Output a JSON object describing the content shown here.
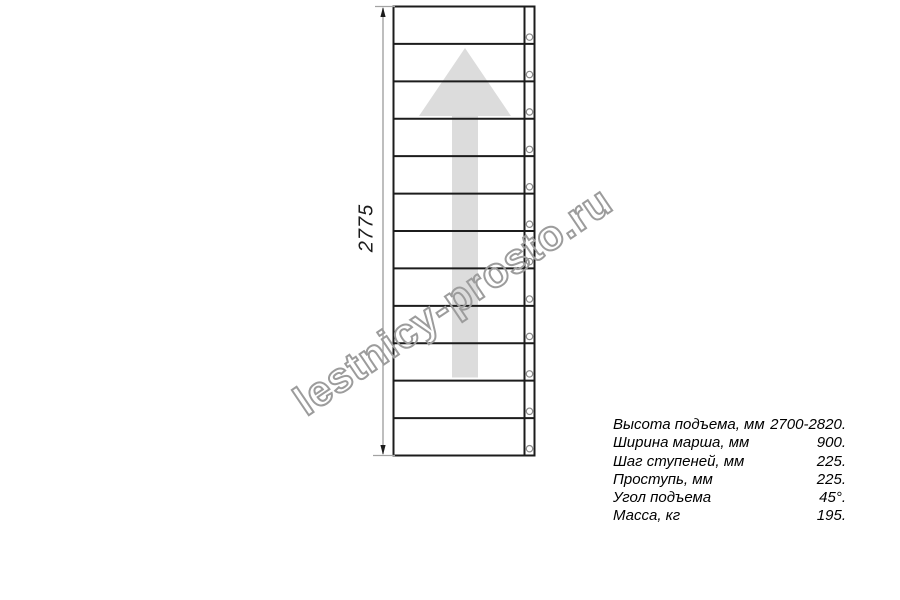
{
  "drawing": {
    "title": "staircase-top-view",
    "steps": 12,
    "dimension": {
      "label": "2775"
    },
    "direction_arrow": "up",
    "colors": {
      "line": "#1c1c1c",
      "dimension_line": "#a3a3a3",
      "arrow_fill": "#dcdcdc",
      "circle_stroke": "#8a8a8a"
    }
  },
  "watermark": {
    "text": "lestnicy-prosto.ru",
    "color": "#9c9c9c"
  },
  "specs": {
    "rows": [
      {
        "label": "Высота подъема, мм",
        "value": "2700-2820."
      },
      {
        "label": "Ширина марша, мм",
        "value": "900."
      },
      {
        "label": "Шаг ступеней, мм",
        "value": "225."
      },
      {
        "label": "Проступь, мм",
        "value": "225."
      },
      {
        "label": "Угол подъема",
        "value": "45°."
      },
      {
        "label": "Масса, кг",
        "value": "195."
      }
    ]
  }
}
